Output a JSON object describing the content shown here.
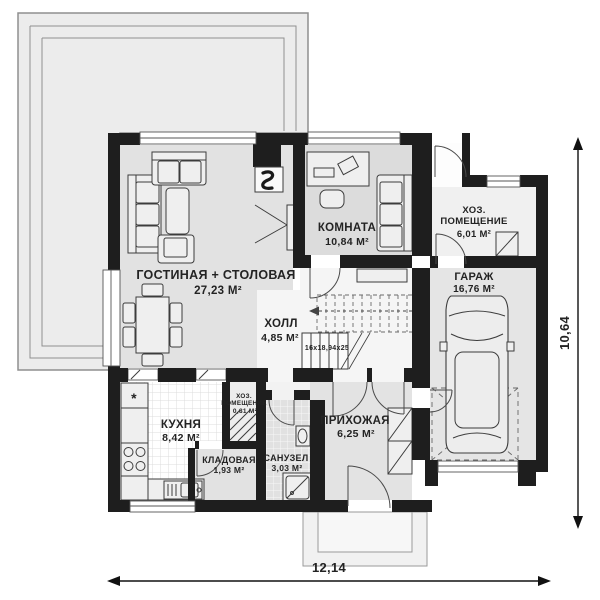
{
  "plan": {
    "rooms": {
      "living": {
        "name": "ГОСТИНАЯ + СТОЛОВАЯ",
        "area": "27,23 М²"
      },
      "room": {
        "name": "КОМНАТА",
        "area": "10,84 М²"
      },
      "utility": {
        "line1": "ХОЗ.",
        "line2": "ПОМЕЩЕНИЕ",
        "area": "6,01 М²"
      },
      "garage": {
        "name": "ГАРАЖ",
        "area": "16,76 М²"
      },
      "hall": {
        "name": "ХОЛЛ",
        "area": "4,85 М²"
      },
      "kitchen": {
        "name": "КУХНЯ",
        "area": "8,42 М²"
      },
      "utility_small": {
        "line1": "ХОЗ.",
        "line2": "ПОМЕЩЕНИЕ",
        "area": "0,81 М²"
      },
      "pantry": {
        "name": "КЛАДОВАЯ",
        "area": "1,93 М²"
      },
      "bathroom": {
        "name": "САНУЗЕЛ",
        "area": "3,03 М²"
      },
      "entry": {
        "name": "ПРИХОЖАЯ",
        "area": "6,25 М²"
      }
    },
    "stairs": {
      "label": "16x18,94x25"
    },
    "dimensions": {
      "width": "12,14",
      "height": "10,64"
    },
    "symbols": {
      "fridge": "*"
    },
    "colors": {
      "wall": "#1e1e1e",
      "living_floor": "#e2e2e2",
      "hall_floor": "#f5f5f5",
      "terrace": "#ececec",
      "outline": "#3c3c3c"
    }
  }
}
